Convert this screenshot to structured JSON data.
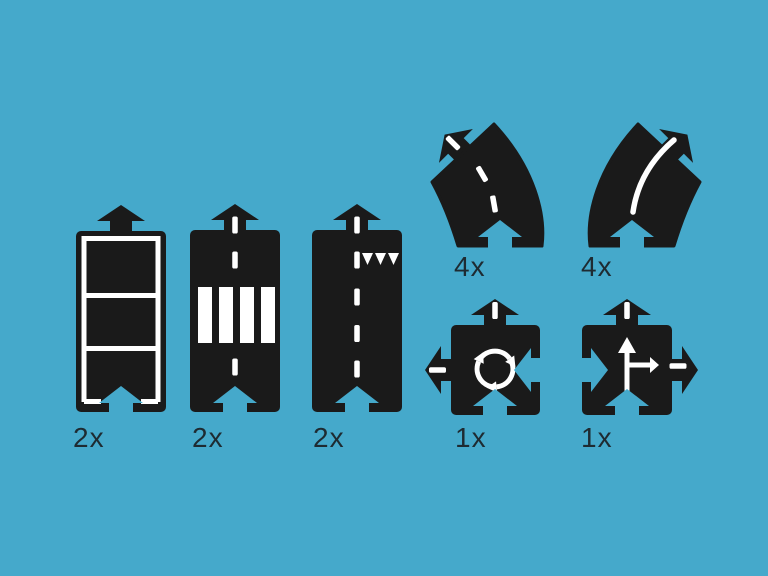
{
  "colors": {
    "background": "#45a9cb",
    "piece": "#1a1a1a",
    "marking": "#ffffff",
    "label": "#1e2b32"
  },
  "pieces": [
    {
      "name": "straight-road-white-border",
      "count_label": "2x"
    },
    {
      "name": "straight-road-zebra-crossing",
      "count_label": "2x"
    },
    {
      "name": "straight-road-dashed-give-way",
      "count_label": "2x"
    },
    {
      "name": "curve-45-left-dashed-line",
      "count_label": "4x"
    },
    {
      "name": "curve-45-right-solid-line",
      "count_label": "4x"
    },
    {
      "name": "roundabout-crossing",
      "count_label": "1x"
    },
    {
      "name": "t-junction-crossing",
      "count_label": "1x"
    }
  ],
  "icons": {
    "roundabout_marking": "circular-arrows",
    "junction_marking": "up-and-right-arrows",
    "give_way_marking": "shark-teeth-triangles",
    "connector_tab": "arrow-tab",
    "connector_slot": "arrow-slot"
  }
}
